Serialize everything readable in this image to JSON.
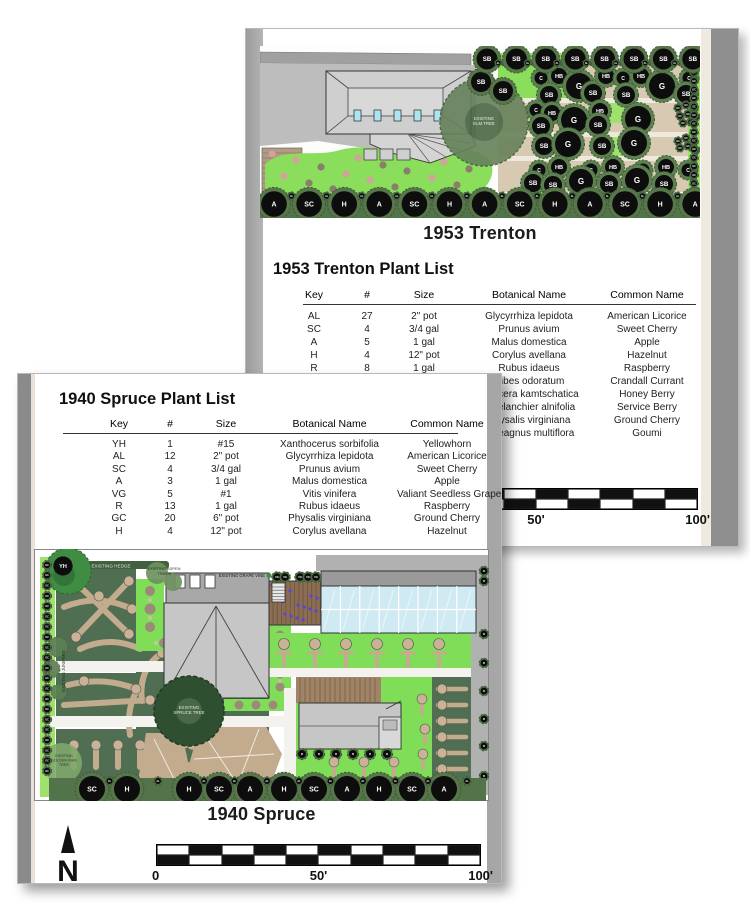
{
  "trenton": {
    "plan_title": "1953 Trenton",
    "list_heading": "1953 Trenton Plant List",
    "table": {
      "columns": [
        "Key",
        "#",
        "Size",
        "Botanical Name",
        "Common Name"
      ],
      "rows": [
        [
          "AL",
          "27",
          "2\" pot",
          "Glycyrrhiza lepidota",
          "American Licorice"
        ],
        [
          "SC",
          "4",
          "3/4 gal",
          "Prunus avium",
          "Sweet Cherry"
        ],
        [
          "A",
          "5",
          "1 gal",
          "Malus domestica",
          "Apple"
        ],
        [
          "H",
          "4",
          "12\" pot",
          "Corylus avellana",
          "Hazelnut"
        ],
        [
          "R",
          "8",
          "1 gal",
          "Rubus idaeus",
          "Raspberry"
        ],
        [
          "C",
          "7",
          "5 gal",
          "Ribes odoratum",
          "Crandall Currant"
        ],
        [
          "",
          "",
          "",
          "Lonicera kamtschatica",
          "Honey Berry"
        ],
        [
          "",
          "",
          "",
          "Amelanchier alnifolia",
          "Service Berry"
        ],
        [
          "",
          "",
          "",
          "Physalis virginiana",
          "Ground Cherry"
        ],
        [
          "",
          "",
          "",
          "Elaeagnus multiflora",
          "Goumi"
        ]
      ]
    },
    "scale_labels": [
      "0",
      "50'",
      "100'"
    ],
    "plan": {
      "existing_elm": [
        "EXISTING",
        "ELM TREE"
      ],
      "top_row_label": "SB",
      "bottom_row": [
        "A",
        "SC",
        "H",
        "A",
        "SC",
        "H",
        "A",
        "SC",
        "H",
        "A",
        "SC",
        "H",
        "A"
      ],
      "small_dot": "AL",
      "edge_dot": "GC",
      "cluster_labels": {
        "G": "G",
        "HB": "HB",
        "C": "C",
        "SB": "SB"
      }
    }
  },
  "spruce": {
    "plan_title": "1940 Spruce",
    "list_heading": "1940 Spruce Plant List",
    "north": "N",
    "table": {
      "columns": [
        "Key",
        "#",
        "Size",
        "Botanical Name",
        "Common Name"
      ],
      "rows": [
        [
          "YH",
          "1",
          "#15",
          "Xanthocerus sorbifolia",
          "Yellowhorn"
        ],
        [
          "AL",
          "12",
          "2\" pot",
          "Glycyrrhiza lepidota",
          "American Licorice"
        ],
        [
          "SC",
          "4",
          "3/4 gal",
          "Prunus avium",
          "Sweet Cherry"
        ],
        [
          "A",
          "3",
          "1 gal",
          "Malus domestica",
          "Apple"
        ],
        [
          "VG",
          "5",
          "#1",
          "Vitis vinifera",
          "Valiant Seedless Grape"
        ],
        [
          "R",
          "13",
          "1 gal",
          "Rubus idaeus",
          "Raspberry"
        ],
        [
          "GC",
          "20",
          "6\" pot",
          "Physalis virginiana",
          "Ground Cherry"
        ],
        [
          "H",
          "4",
          "12\" pot",
          "Corylus avellana",
          "Hazelnut"
        ]
      ]
    },
    "scale_labels": [
      "0",
      "50'",
      "100'"
    ],
    "plan": {
      "yellowhorn": "YH",
      "grape_dot": "VG",
      "edge_left_dot": "GC",
      "edge_right_dot": "R",
      "garage_dot": "R",
      "small_dot": "AL",
      "bottom_row": [
        "SC",
        "H",
        "H",
        "SC",
        "A",
        "H",
        "SC",
        "A",
        "H",
        "SC",
        "A"
      ],
      "existing": {
        "hedge": "EXISTING HEDGE",
        "aspen": [
          "EXISTING ASPEN",
          "TREES"
        ],
        "junipers": "EXISTING JUNIPERS",
        "grape": "EXISTING GRAPE VINE",
        "spruce": [
          "EXISTING",
          "SPRUCE TREE"
        ],
        "golden_rain": [
          "EXISTING",
          "GOLDEN RAIN",
          "TREE"
        ]
      }
    }
  },
  "colors": {
    "groundcover": "#8ade5c",
    "bed_green": "#7fdd58",
    "lawn_dark": "#4f6e52",
    "flagstone": "#c3ab8d",
    "flagstone_field": "#d8cab2",
    "crown_green": "#5d8050",
    "glass": "#cfeaf2",
    "deck_wood": "#8a6d52",
    "deck_flower": "#5946d6"
  }
}
